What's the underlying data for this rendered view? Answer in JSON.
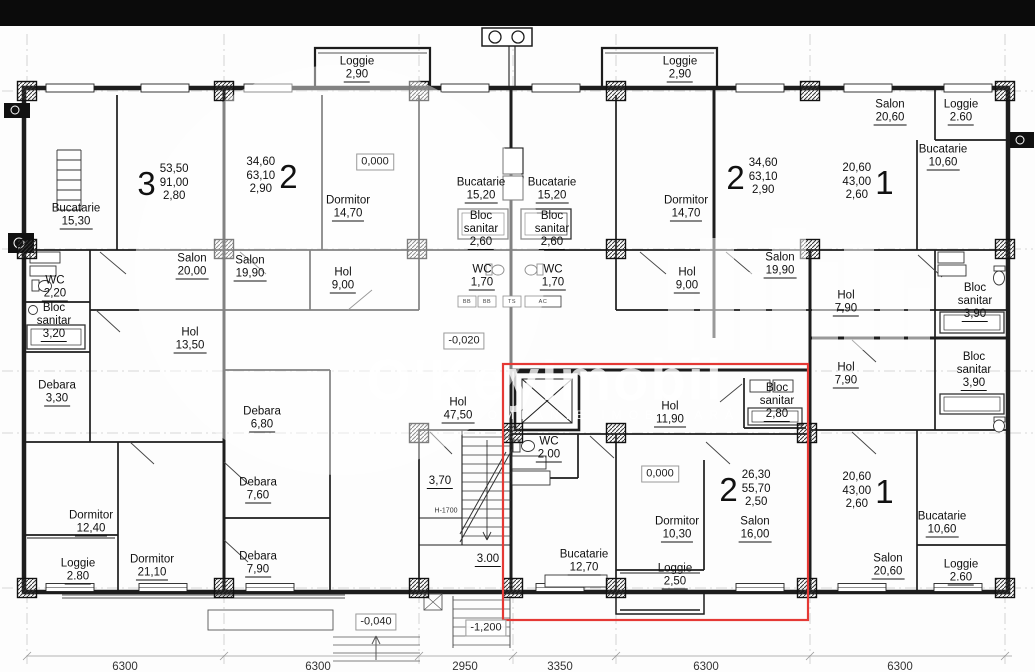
{
  "watermark": {
    "title": "O'KeyImobil",
    "subtitle": "COMPANIE IMOBILIARĂ"
  },
  "highlight_color": "#e53935",
  "rooms": [
    {
      "n": "Loggie",
      "v": "2,90",
      "x": 357,
      "y": 69
    },
    {
      "n": "Loggie",
      "v": "2,90",
      "x": 680,
      "y": 69
    },
    {
      "n": "Salon",
      "v": "20,60",
      "x": 890,
      "y": 112
    },
    {
      "n": "Loggie",
      "v": "2.60",
      "x": 961,
      "y": 112
    },
    {
      "n": "Bucatarie",
      "v": "10,60",
      "x": 943,
      "y": 157
    },
    {
      "n": "Bucatarie",
      "v": "15,30",
      "x": 76,
      "y": 216
    },
    {
      "n": "Dormitor",
      "v": "14,70",
      "x": 348,
      "y": 208
    },
    {
      "n": "Bucatarie",
      "v": "15,20",
      "x": 481,
      "y": 190
    },
    {
      "n": "Bucatarie",
      "v": "15,20",
      "x": 552,
      "y": 190
    },
    {
      "n": "Bloc\nsanitar",
      "v": "2,60",
      "x": 481,
      "y": 230
    },
    {
      "n": "Bloc\nsanitar",
      "v": "2,60",
      "x": 552,
      "y": 230
    },
    {
      "n": "WC",
      "v": "1,70",
      "x": 482,
      "y": 277
    },
    {
      "n": "WC",
      "v": "1,70",
      "x": 553,
      "y": 277
    },
    {
      "n": "Dormitor",
      "v": "14,70",
      "x": 686,
      "y": 208
    },
    {
      "n": "Salon",
      "v": "20,00",
      "x": 192,
      "y": 266
    },
    {
      "n": "Salon",
      "v": "19,90",
      "x": 250,
      "y": 268
    },
    {
      "n": "Hol",
      "v": "9,00",
      "x": 343,
      "y": 280
    },
    {
      "n": "Hol",
      "v": "9,00",
      "x": 687,
      "y": 280
    },
    {
      "n": "Salon",
      "v": "19,90",
      "x": 780,
      "y": 265
    },
    {
      "n": "WC",
      "v": "2,20",
      "x": 55,
      "y": 288
    },
    {
      "n": "Bloc\nsanitar",
      "v": "3,20",
      "x": 54,
      "y": 322
    },
    {
      "n": "Debara",
      "v": "3,30",
      "x": 57,
      "y": 393
    },
    {
      "n": "Hol",
      "v": "13,50",
      "x": 190,
      "y": 340
    },
    {
      "n": "Hol",
      "v": "7,90",
      "x": 846,
      "y": 303
    },
    {
      "n": "Bloc\nsanitar",
      "v": "3,90",
      "x": 975,
      "y": 302
    },
    {
      "n": "Hol",
      "v": "7,90",
      "x": 846,
      "y": 375
    },
    {
      "n": "Bloc\nsanitar",
      "v": "3,90",
      "x": 974,
      "y": 371
    },
    {
      "n": "Debara",
      "v": "6,80",
      "x": 262,
      "y": 419
    },
    {
      "n": "Debara",
      "v": "7,60",
      "x": 258,
      "y": 490
    },
    {
      "n": "Debara",
      "v": "7,90",
      "x": 258,
      "y": 564
    },
    {
      "n": "Dormitor",
      "v": "12,40",
      "x": 91,
      "y": 523
    },
    {
      "n": "Loggie",
      "v": "2.80",
      "x": 78,
      "y": 571
    },
    {
      "n": "Dormitor",
      "v": "21,10",
      "x": 152,
      "y": 567
    },
    {
      "n": "Hol",
      "v": "47,50",
      "x": 458,
      "y": 410
    },
    {
      "n": "Hol",
      "v": "11,90",
      "x": 670,
      "y": 414
    },
    {
      "n": "WC",
      "v": "2.00",
      "x": 549,
      "y": 449
    },
    {
      "n": "Bloc\nsanitar",
      "v": "2,80",
      "x": 777,
      "y": 402
    },
    {
      "n": "Dormitor",
      "v": "10,30",
      "x": 677,
      "y": 529
    },
    {
      "n": "Salon",
      "v": "16,00",
      "x": 755,
      "y": 529
    },
    {
      "n": "Bucatarie",
      "v": "12,70",
      "x": 584,
      "y": 562
    },
    {
      "n": "Loggie",
      "v": "2,50",
      "x": 675,
      "y": 576
    },
    {
      "n": "Bucatarie",
      "v": "10,60",
      "x": 942,
      "y": 524
    },
    {
      "n": "Salon",
      "v": "20,60",
      "x": 888,
      "y": 566
    },
    {
      "n": "Loggie",
      "v": "2.60",
      "x": 961,
      "y": 572
    },
    {
      "n": "",
      "v": "3,70",
      "x": 440,
      "y": 482
    },
    {
      "n": "",
      "v": "3.00",
      "x": 488,
      "y": 560
    }
  ],
  "apartments": [
    {
      "t": "3",
      "a": [
        "53,50",
        "91,00",
        "2,80"
      ],
      "x": 163,
      "y": 183,
      "side": "left"
    },
    {
      "t": "2",
      "a": [
        "34,60",
        "63,10",
        "2,90"
      ],
      "x": 272,
      "y": 176,
      "side": "right"
    },
    {
      "t": "2",
      "a": [
        "34,60",
        "63,10",
        "2,90"
      ],
      "x": 752,
      "y": 177,
      "side": "left"
    },
    {
      "t": "1",
      "a": [
        "20,60",
        "43,00",
        "2,60"
      ],
      "x": 868,
      "y": 182,
      "side": "right"
    },
    {
      "t": "2",
      "a": [
        "26,30",
        "55,70",
        "2,50"
      ],
      "x": 745,
      "y": 489,
      "side": "left"
    },
    {
      "t": "1",
      "a": [
        "20,60",
        "43,00",
        "2,60"
      ],
      "x": 868,
      "y": 491,
      "side": "right"
    }
  ],
  "elevations": [
    {
      "v": "0,000",
      "x": 375,
      "y": 162
    },
    {
      "v": "-0,020",
      "x": 464,
      "y": 341
    },
    {
      "v": "0,000",
      "x": 660,
      "y": 474
    },
    {
      "v": "-0,040",
      "x": 376,
      "y": 622
    },
    {
      "v": "-1,200",
      "x": 486,
      "y": 628
    }
  ],
  "annotations": [
    {
      "t": "H-1700",
      "x": 446,
      "y": 511
    }
  ],
  "utilities": [
    {
      "t": "BB",
      "x": 467,
      "y": 302
    },
    {
      "t": "BB",
      "x": 487,
      "y": 302
    },
    {
      "t": "TS",
      "x": 512,
      "y": 302
    },
    {
      "t": "AC",
      "x": 543,
      "y": 302
    }
  ],
  "dimensions": [
    {
      "v": "6300",
      "x": 125
    },
    {
      "v": "6300",
      "x": 318
    },
    {
      "v": "2950",
      "x": 465
    },
    {
      "v": "3350",
      "x": 560
    },
    {
      "v": "6300",
      "x": 706
    },
    {
      "v": "6300",
      "x": 900
    }
  ]
}
